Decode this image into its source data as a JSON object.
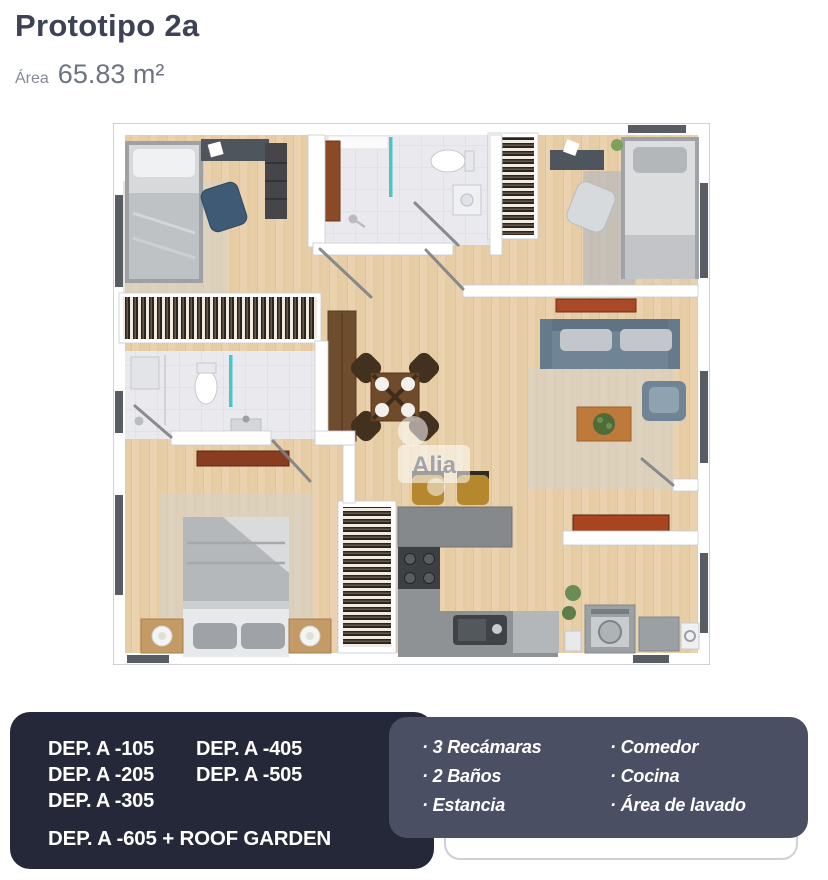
{
  "header": {
    "title": "Prototipo 2a",
    "area_label": "Área",
    "area_value": "65.83 m²"
  },
  "floorplan": {
    "watermark": "Alia"
  },
  "units_panel": {
    "column_a": [
      "DEP. A -105",
      "DEP. A -205",
      "DEP. A -305"
    ],
    "column_b": [
      "DEP. A -405",
      "DEP. A -505"
    ],
    "footnote": "DEP. A -605 + ROOF GARDEN"
  },
  "features_panel": {
    "column_1": [
      "· 3 Recámaras",
      "· 2 Baños",
      "· Estancia"
    ],
    "column_2": [
      "· Comedor",
      "· Cocina",
      "· Área de lavado"
    ]
  },
  "colors": {
    "title": "#3d4354",
    "subtitle": "#6d7380",
    "dark_panel": "#252839",
    "light_panel": "#4b4f63",
    "floor_wood": "#e6cda6",
    "accent_teal": "#49c5c9"
  }
}
